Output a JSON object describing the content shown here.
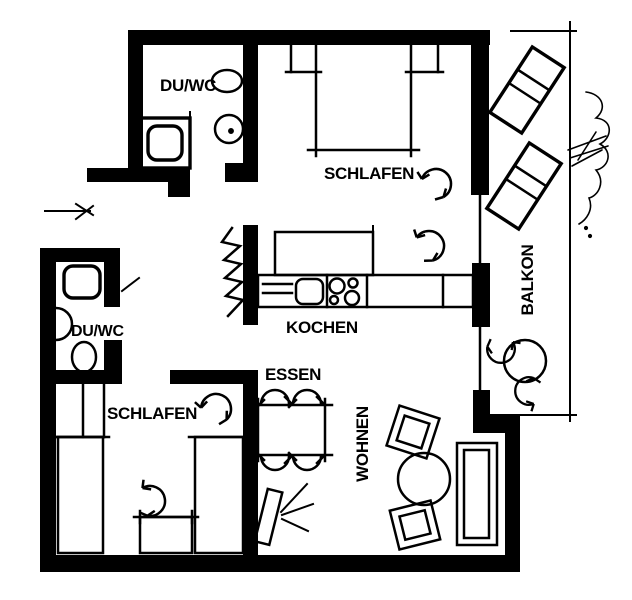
{
  "plan": {
    "type": "apartment-floor-plan",
    "language": "de",
    "colors": {
      "ink": "#000000",
      "paper": "#ffffff"
    },
    "rooms": {
      "bathroom_top": {
        "label": "DU/WC",
        "fixtures": [
          "shower",
          "toilet",
          "washbasin"
        ]
      },
      "bedroom_top": {
        "label": "SCHLAFEN",
        "fixtures": [
          "double-bed",
          "nightstand",
          "nightstand"
        ]
      },
      "kitchen": {
        "label": "KOCHEN",
        "fixtures": [
          "tall-cabinet",
          "counter",
          "sink",
          "stove",
          "coat-rack"
        ]
      },
      "dining": {
        "label": "ESSEN",
        "fixtures": [
          "dining-table",
          "chair",
          "chair",
          "chair",
          "chair",
          "floor-lamp"
        ]
      },
      "bathroom_bottom": {
        "label": "DU/WC",
        "fixtures": [
          "shower",
          "washbasin",
          "toilet"
        ]
      },
      "bedroom_bottom": {
        "label": "SCHLAFEN",
        "fixtures": [
          "wardrobe",
          "single-bed",
          "single-bed",
          "desk",
          "chair"
        ]
      },
      "living": {
        "label": "WOHNEN",
        "fixtures": [
          "sofa",
          "coffee-table",
          "armchair",
          "armchair"
        ]
      },
      "balcony": {
        "label": "BALKON",
        "fixtures": [
          "sun-lounger",
          "sun-lounger",
          "plant",
          "round-table",
          "chair",
          "chair"
        ]
      }
    },
    "has_entrance_arrow": true
  }
}
